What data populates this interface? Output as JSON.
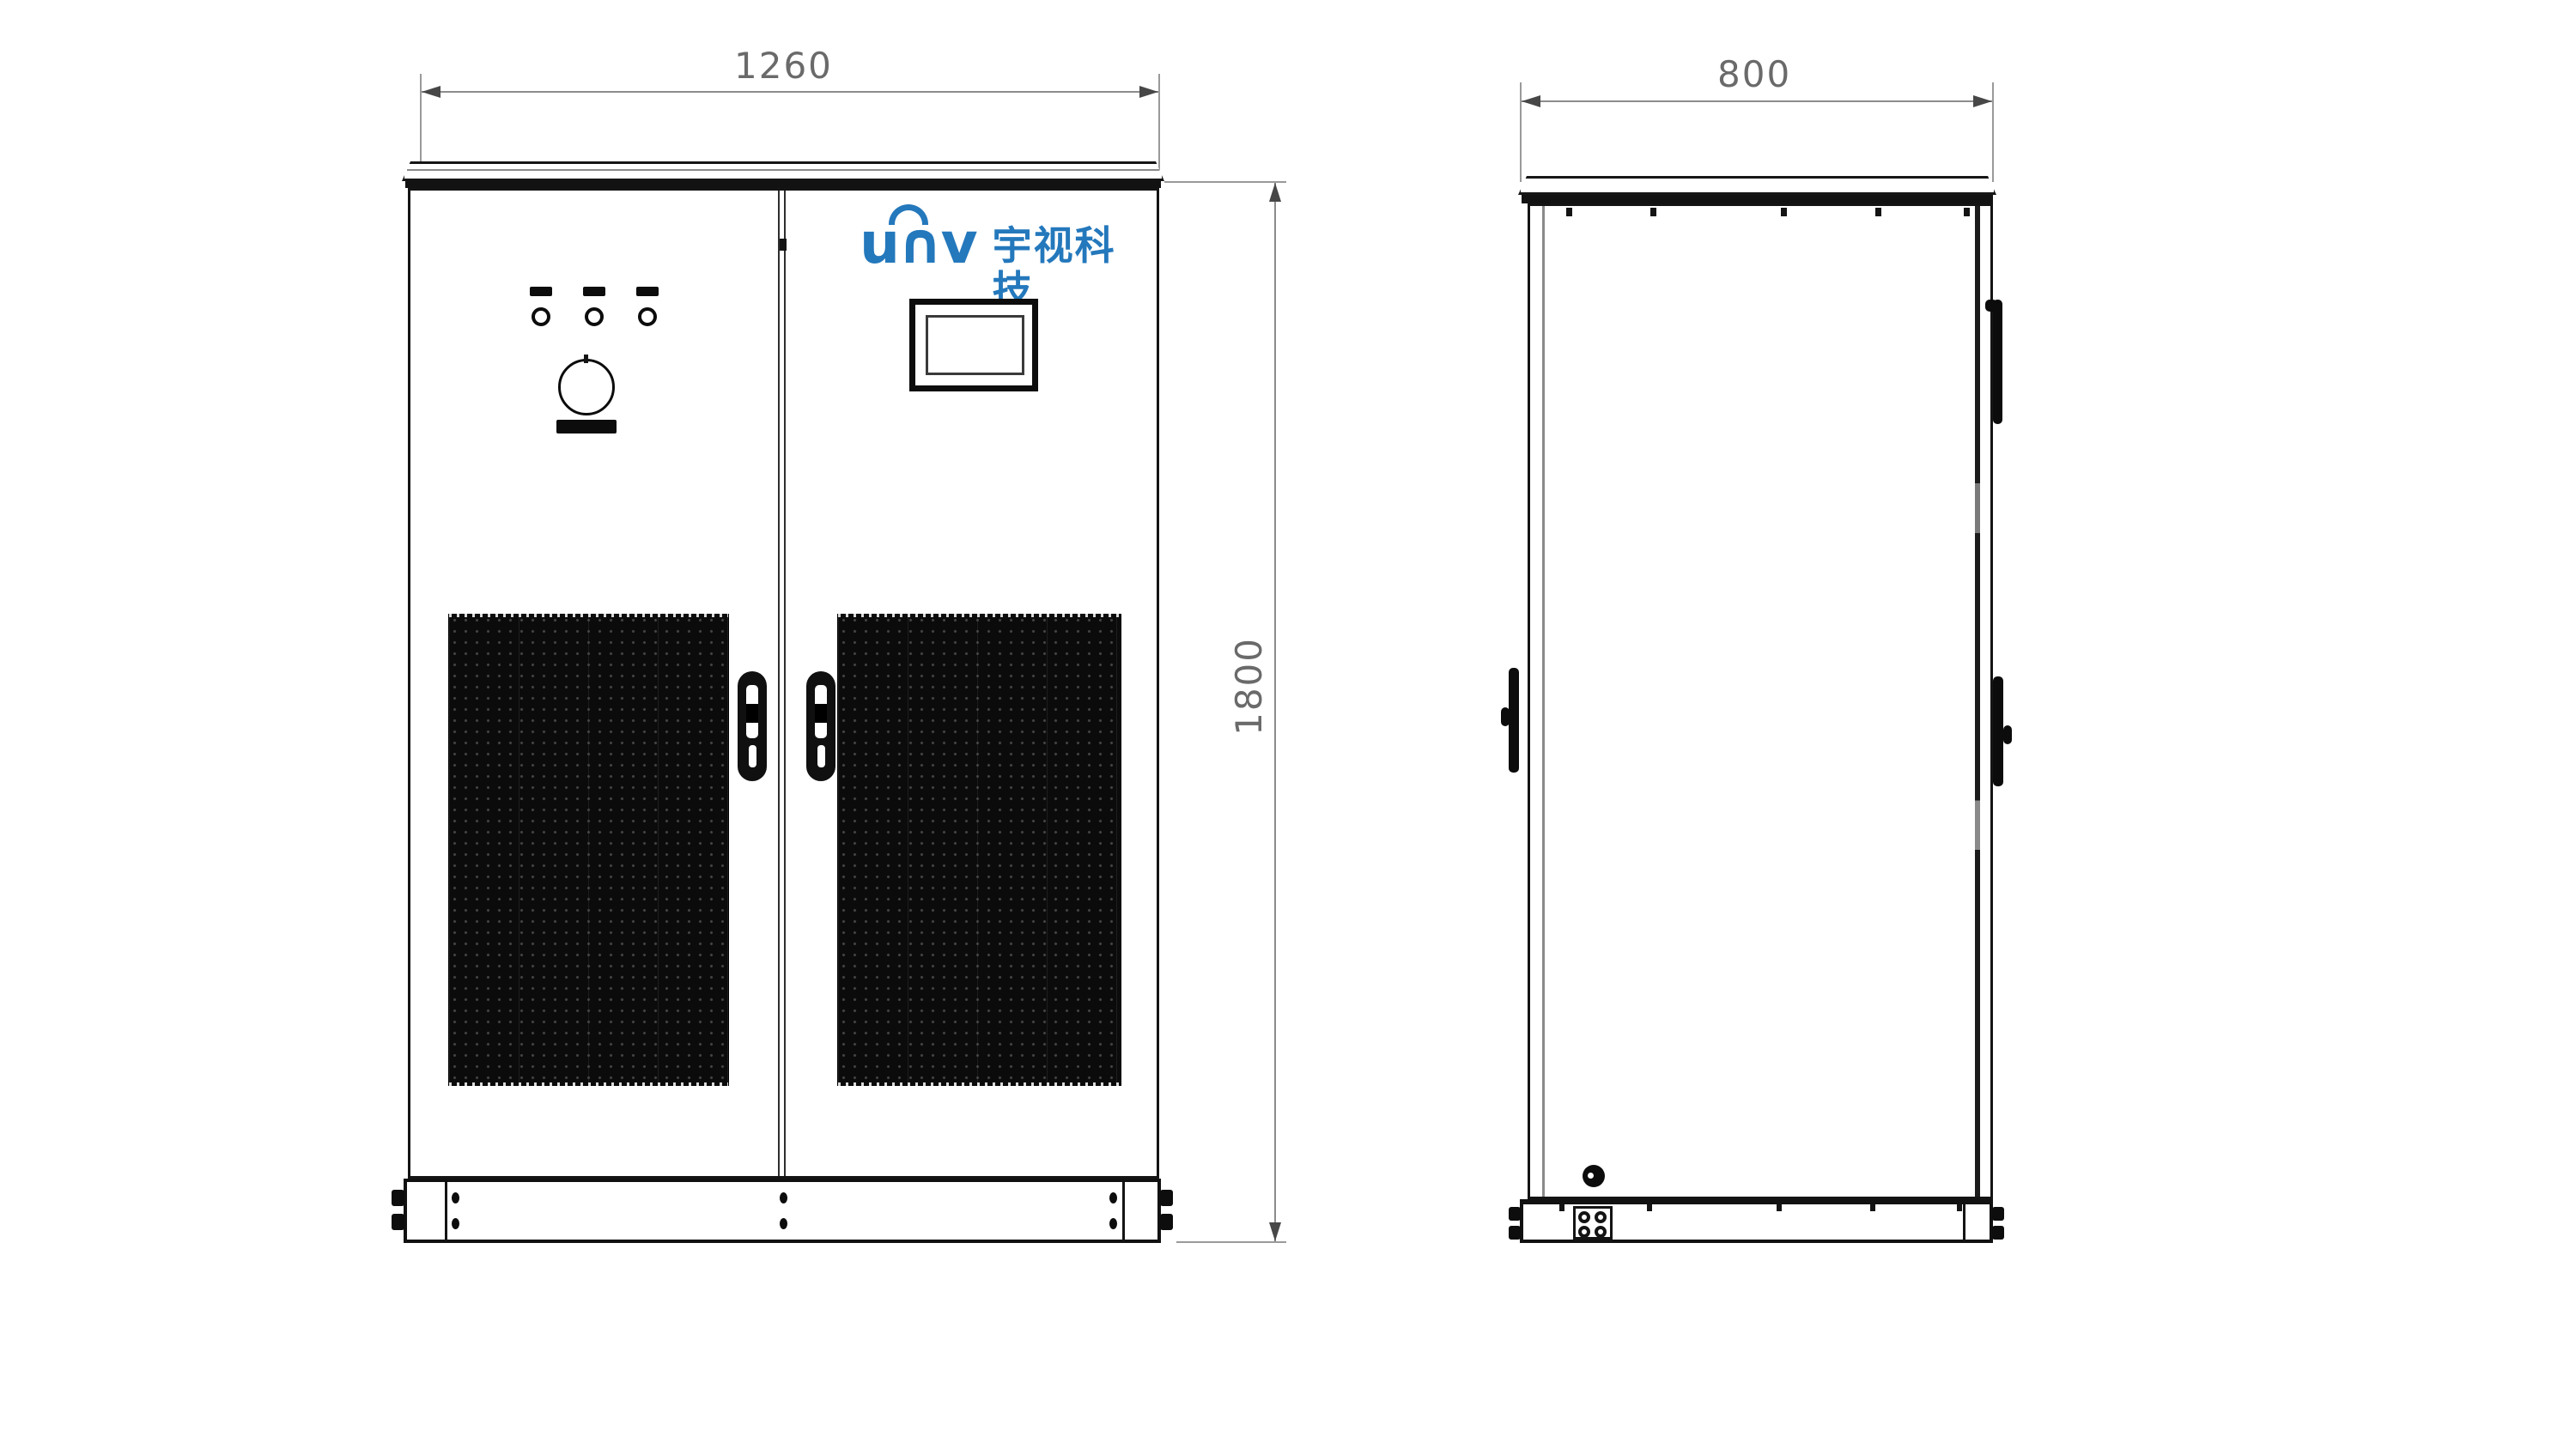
{
  "drawing": {
    "kind": "cabinet-technical-drawing",
    "views": {
      "front": {
        "width_label": "1260",
        "height_label": "1800"
      },
      "side": {
        "depth_label": "800"
      }
    },
    "brand": {
      "wordmark": "u∩v",
      "company": "宇视科技",
      "brand_color": "#2478BC"
    },
    "front_panel": {
      "indicator_light_count": 3,
      "has_emergency_stop": true,
      "has_display": true,
      "vent_grille_count": 2,
      "door_handle_count": 2
    },
    "colors": {
      "line": "#141414",
      "dimension_line": "#8c8c8c",
      "dimension_text": "#6a6a6a",
      "grille_fill": "#0b0b0b",
      "background": "#ffffff"
    }
  }
}
